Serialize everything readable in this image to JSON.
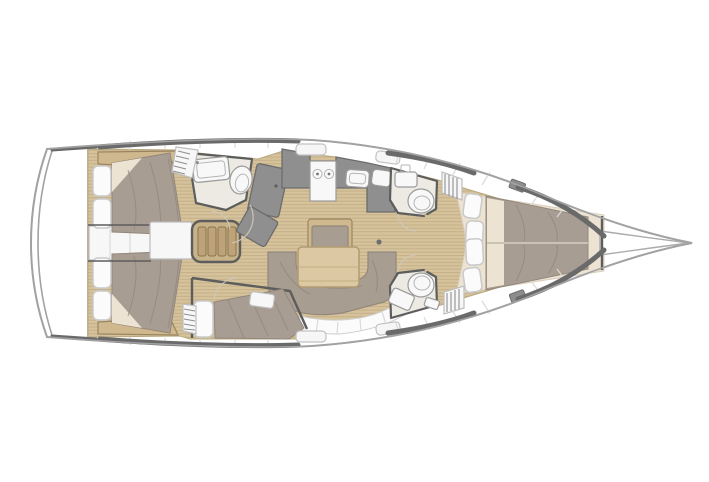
{
  "image": {
    "kind": "yacht-interior-floorplan",
    "orientation": "bow-right",
    "visible_text": ""
  },
  "colors": {
    "hull_line": "#a2a2a2",
    "rail": "#6a6a6a",
    "wall": "#5d5d5d",
    "deck_seam": "#dadada",
    "wood": "#d6c39c",
    "wood_line": "#c2ad85",
    "wood_trim": "#cfb88d",
    "trim_edge": "#9a8560",
    "bed": "#a89d92",
    "bed_shadow": "#93877b",
    "sheet": "#ece3d3",
    "cushion": "#fbfbfb",
    "cushion_edge": "#c9c9c9",
    "counter": "#8f8f8f",
    "counter_edge": "#6c6c6c",
    "fixture": "#f8f8f8",
    "head_floor": "#edeae3",
    "settee": "#a79d91",
    "table": "#dcc9a3",
    "steps": "#c8b287",
    "white_box": "#f7f7f7"
  },
  "zones": {
    "hull": {
      "label": "yacht hull, bow pointing right"
    },
    "transom": {
      "label": "stern transom and swim platform"
    },
    "aft_cabin_port": {
      "label": "aft double cabin, port side"
    },
    "aft_cabin_starboard": {
      "label": "aft double cabin, starboard side"
    },
    "companionway": {
      "label": "companionway steps and engine box"
    },
    "head_aft_port": {
      "label": "aft head with sink and toilet"
    },
    "nav_station": {
      "label": "chart table modules"
    },
    "galley": {
      "label": "galley with stove and sinks"
    },
    "saloon": {
      "label": "saloon with U-settee, table and bench"
    },
    "mid_cabin_starboard": {
      "label": "mid starboard berth cabin"
    },
    "head_fwd_port": {
      "label": "forward head, port side"
    },
    "head_fwd_starboard": {
      "label": "forward head, starboard side"
    },
    "forward_cabin": {
      "label": "forward owner cabin with island bed"
    },
    "bow": {
      "label": "bow and anchor locker"
    }
  }
}
